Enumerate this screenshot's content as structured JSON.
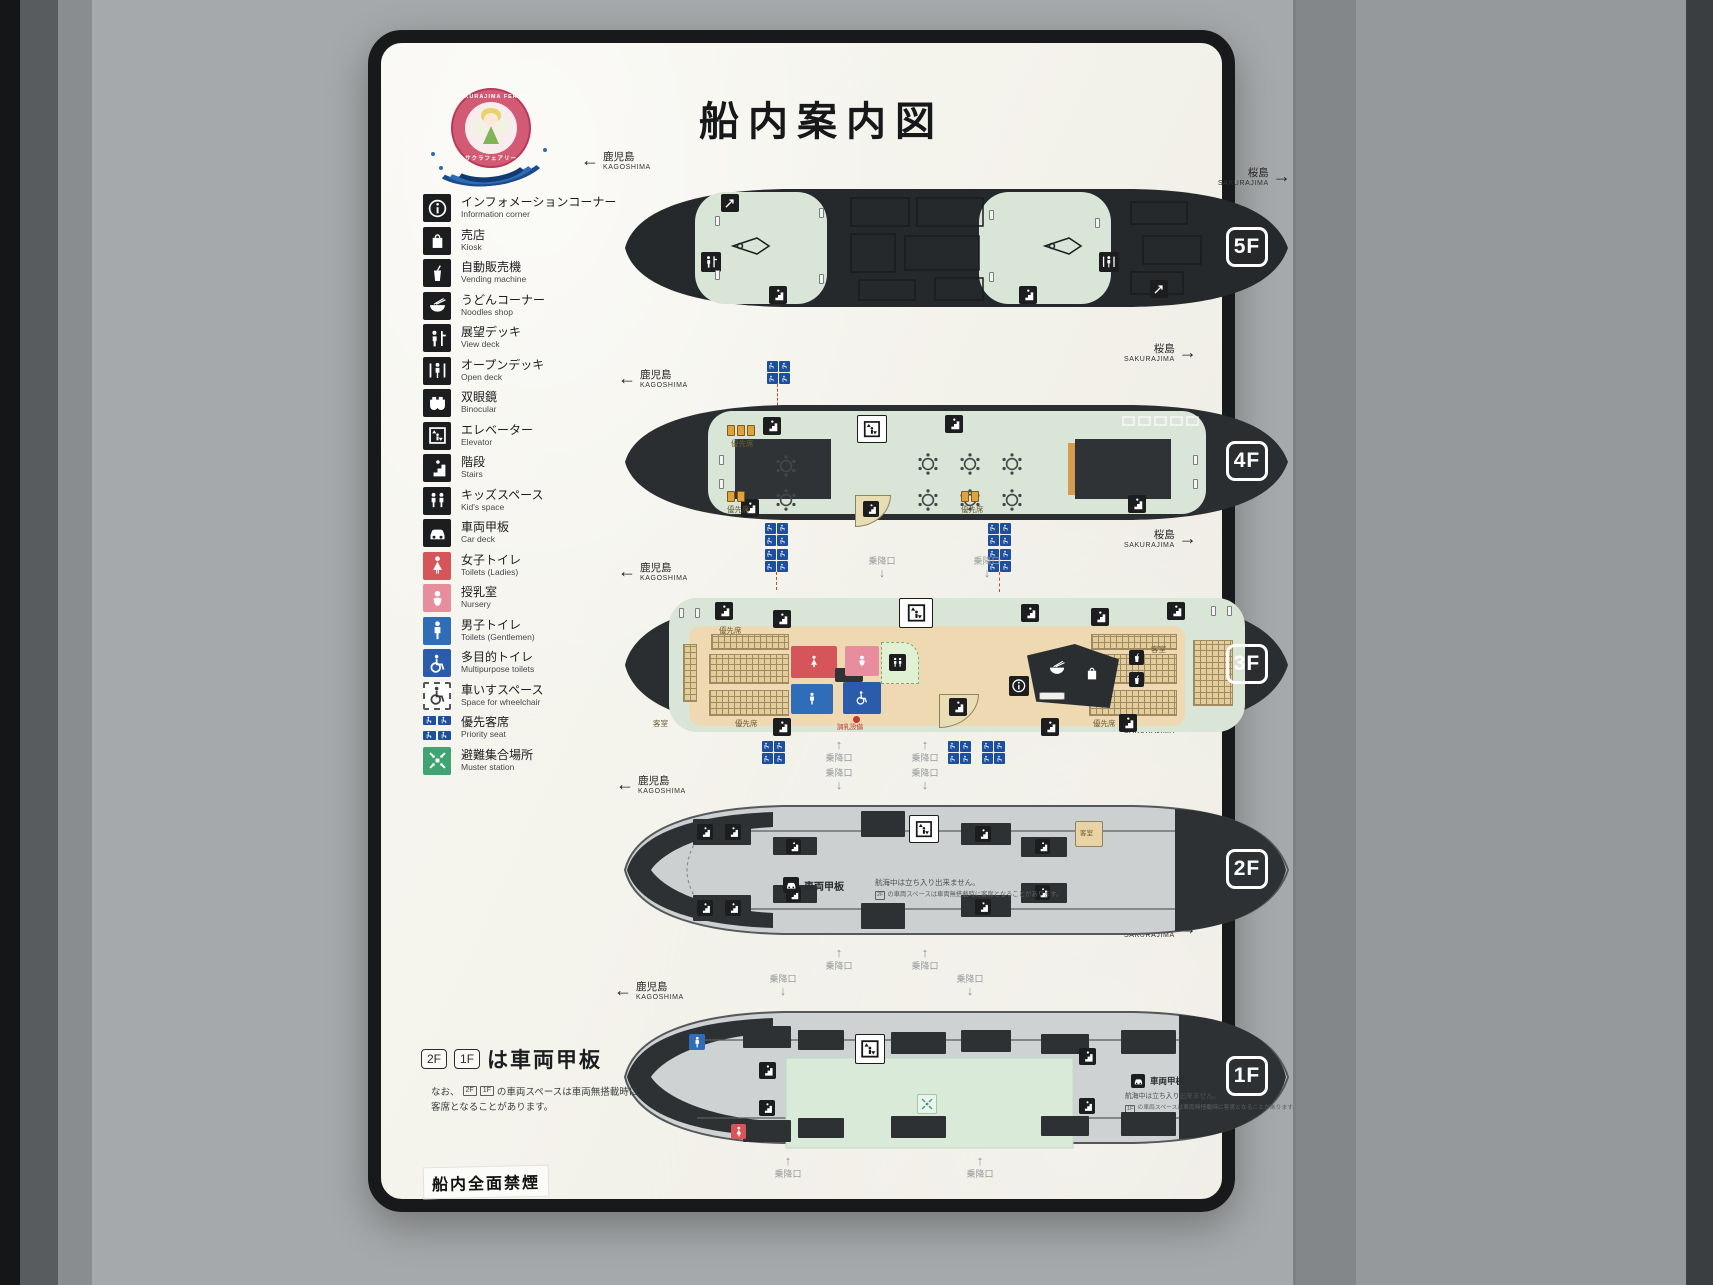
{
  "sign": {
    "title": "船内案内図",
    "no_smoking": "船内全面禁煙",
    "logo": {
      "ring_text_top": "SAKURAJIMA FERRY",
      "ring_text_bottom": "サクラフェアリー"
    }
  },
  "colors": {
    "hull_dark": "#2b2e30",
    "open_deck_mint": "#d9e5d6",
    "cabin_tan": "#eed9b2",
    "car_deck_gray": "#ccd0d1",
    "priority_blue": "#1d4f9e",
    "ladies_red": "#d6555a",
    "nursery_pink": "#e78d9d",
    "gents_blue": "#2f6db8",
    "muster_green": "#3fa372",
    "seat_orange": "#e2a23b"
  },
  "legend": {
    "items": [
      {
        "jp": "インフォメーションコーナー",
        "en": "Information corner"
      },
      {
        "jp": "売店",
        "en": "Kiosk"
      },
      {
        "jp": "自動販売機",
        "en": "Vending machine"
      },
      {
        "jp": "うどんコーナー",
        "en": "Noodles shop"
      },
      {
        "jp": "展望デッキ",
        "en": "View deck"
      },
      {
        "jp": "オープンデッキ",
        "en": "Open deck"
      },
      {
        "jp": "双眼鏡",
        "en": "Binocular"
      },
      {
        "jp": "エレベーター",
        "en": "Elevator"
      },
      {
        "jp": "階段",
        "en": "Stairs"
      },
      {
        "jp": "キッズスペース",
        "en": "Kid's space"
      },
      {
        "jp": "車両甲板",
        "en": "Car deck"
      },
      {
        "jp": "女子トイレ",
        "en": "Toilets (Ladies)"
      },
      {
        "jp": "授乳室",
        "en": "Nursery"
      },
      {
        "jp": "男子トイレ",
        "en": "Toilets (Gentlemen)"
      },
      {
        "jp": "多目的トイレ",
        "en": "Multipurpose toilets"
      },
      {
        "jp": "車いすスペース",
        "en": "Space for wheelchair"
      },
      {
        "jp": "優先客席",
        "en": "Priority seat"
      },
      {
        "jp": "避難集合場所",
        "en": "Muster station"
      }
    ]
  },
  "direction": {
    "left_arrow": "←",
    "left_jp": "鹿児島",
    "left_en": "KAGOSHIMA",
    "right_arrow": "→",
    "right_jp": "桜島",
    "right_en": "SAKURAJIMA"
  },
  "decks": [
    {
      "id": "5F"
    },
    {
      "id": "4F"
    },
    {
      "id": "3F"
    },
    {
      "id": "2F"
    },
    {
      "id": "1F"
    }
  ],
  "deck_labels": {
    "boarding_gate": "乗降口",
    "gate_up": "↑",
    "gate_down": "↓",
    "priority_seat": "優先席",
    "cabin": "客室",
    "car_deck": "車両甲板",
    "car_deck_note": "航海中は立ち入り出来ません。",
    "car_deck_subnote": "の車両スペースは車両無搭載時に客席となることがあります。",
    "nursery_prep": "調乳設備",
    "floor_2f": "2F",
    "floor_1f": "1F"
  },
  "footer": {
    "box_2f": "2F",
    "box_1f": "1F",
    "car_deck_line": "は車両甲板",
    "note_prefix": "なお、",
    "note_mid": "の車両スペースは車両無搭載時に",
    "note_line2": "客席となることがあります。"
  }
}
